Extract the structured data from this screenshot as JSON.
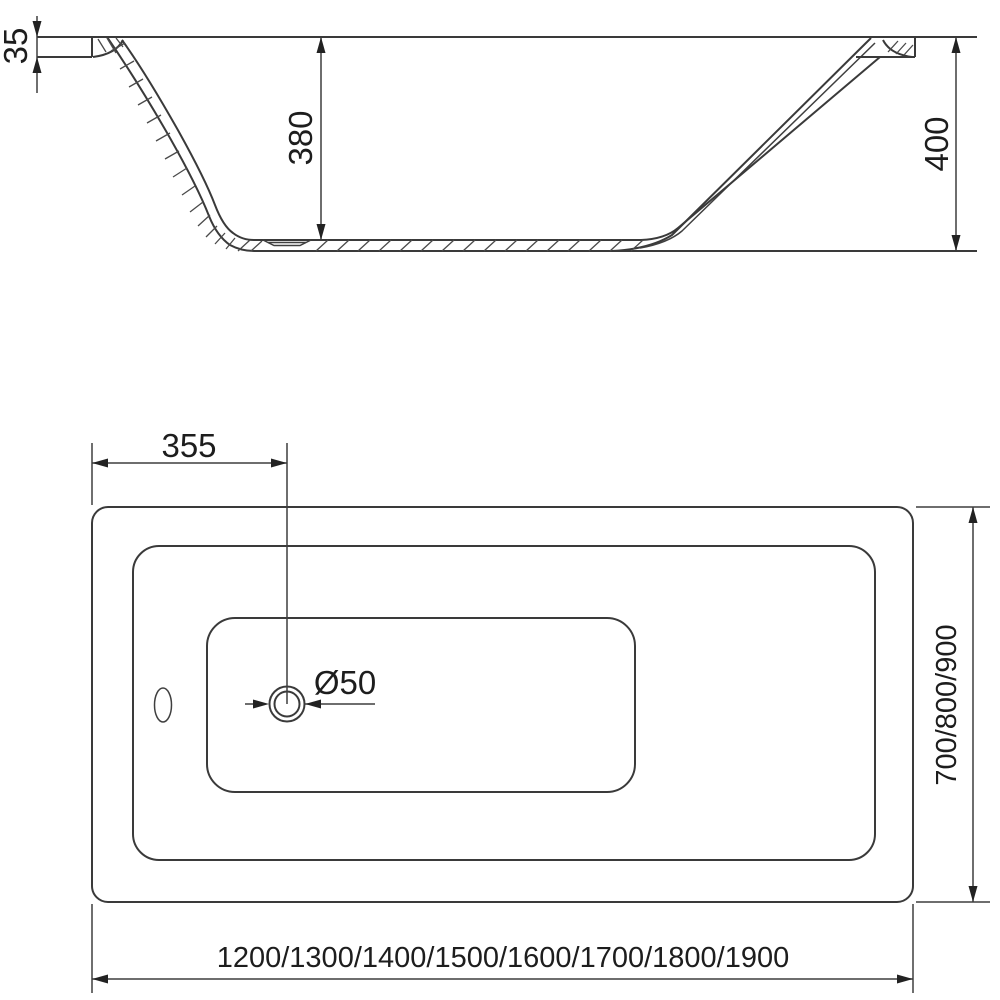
{
  "colors": {
    "background": "#ffffff",
    "line": "#3a3a3a",
    "text": "#1d1d1d"
  },
  "side_section_view": {
    "rim_thickness": "35",
    "inner_depth": "380",
    "overall_height": "400"
  },
  "plan_view": {
    "drain_center_offset": "355",
    "drain_diameter": "Ø50",
    "width_options": "700/800/900",
    "length_options": "1200/1300/1400/1500/1600/1700/1800/1900"
  }
}
